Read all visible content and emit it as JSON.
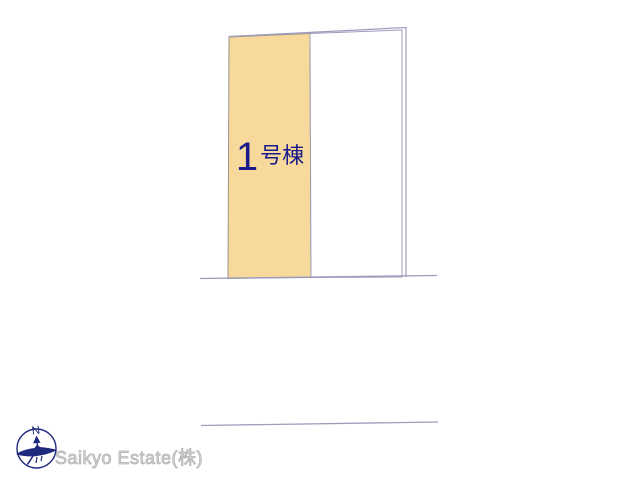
{
  "canvas": {
    "background": "#ffffff",
    "width": 640,
    "height": 480
  },
  "plan": {
    "lot1": {
      "label": "1号棟",
      "number": "1",
      "suffix": "号棟",
      "fill": "#f7d99c",
      "label_color": "#1b1b8c"
    },
    "adjacent_parcel": {
      "fill": "#ffffff"
    },
    "boundary_line_color": "#9d9dbd",
    "lot_outline_color": "#9a948e"
  },
  "compass": {
    "icon": "compass-north-icon",
    "north_label": "N",
    "color": "#1e2a7d"
  },
  "footer": {
    "company": "Saikyo Estate(株)",
    "color": "#c6c6c6"
  }
}
